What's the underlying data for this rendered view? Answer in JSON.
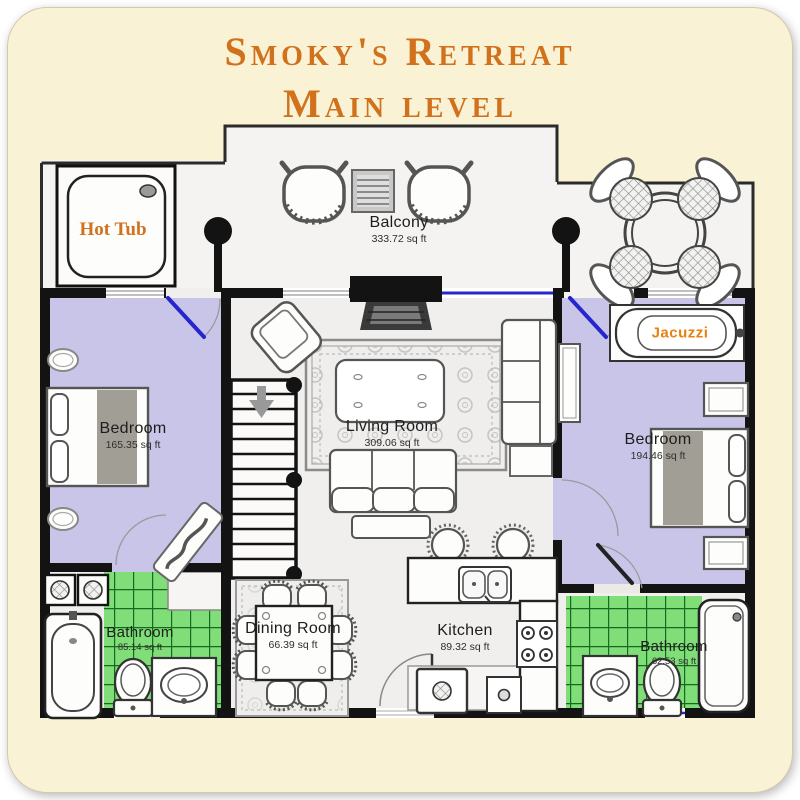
{
  "title": {
    "line1": "Smoky's Retreat",
    "line2": "Main level"
  },
  "rooms": {
    "balcony": {
      "name": "Balcony",
      "area": "333.72 sq ft"
    },
    "bedroom_left": {
      "name": "Bedroom",
      "area": "165.35 sq ft"
    },
    "living_room": {
      "name": "Living Room",
      "area": "309.06 sq ft"
    },
    "bedroom_right": {
      "name": "Bedroom",
      "area": "194.46 sq ft"
    },
    "bathroom_left": {
      "name": "Bathroom",
      "area": "85.14 sq ft"
    },
    "dining_room": {
      "name": "Dining Room",
      "area": "66.39 sq ft"
    },
    "kitchen": {
      "name": "Kitchen",
      "area": "89.32 sq ft"
    },
    "bathroom_right": {
      "name": "Bathroom",
      "area": "62.53 sq ft"
    }
  },
  "features": {
    "hot_tub": "Hot Tub",
    "jacuzzi": "Jacuzzi"
  },
  "colors": {
    "card_background": "#f9f2d4",
    "accent_orange": "#d2711c",
    "bedroom_fill": "#c8c5e9",
    "tile_green": "#80de79",
    "tile_grout": "#17691f",
    "wall_black": "#131313",
    "floor_gray": "#f0efee",
    "door_blue": "#2626cc"
  }
}
